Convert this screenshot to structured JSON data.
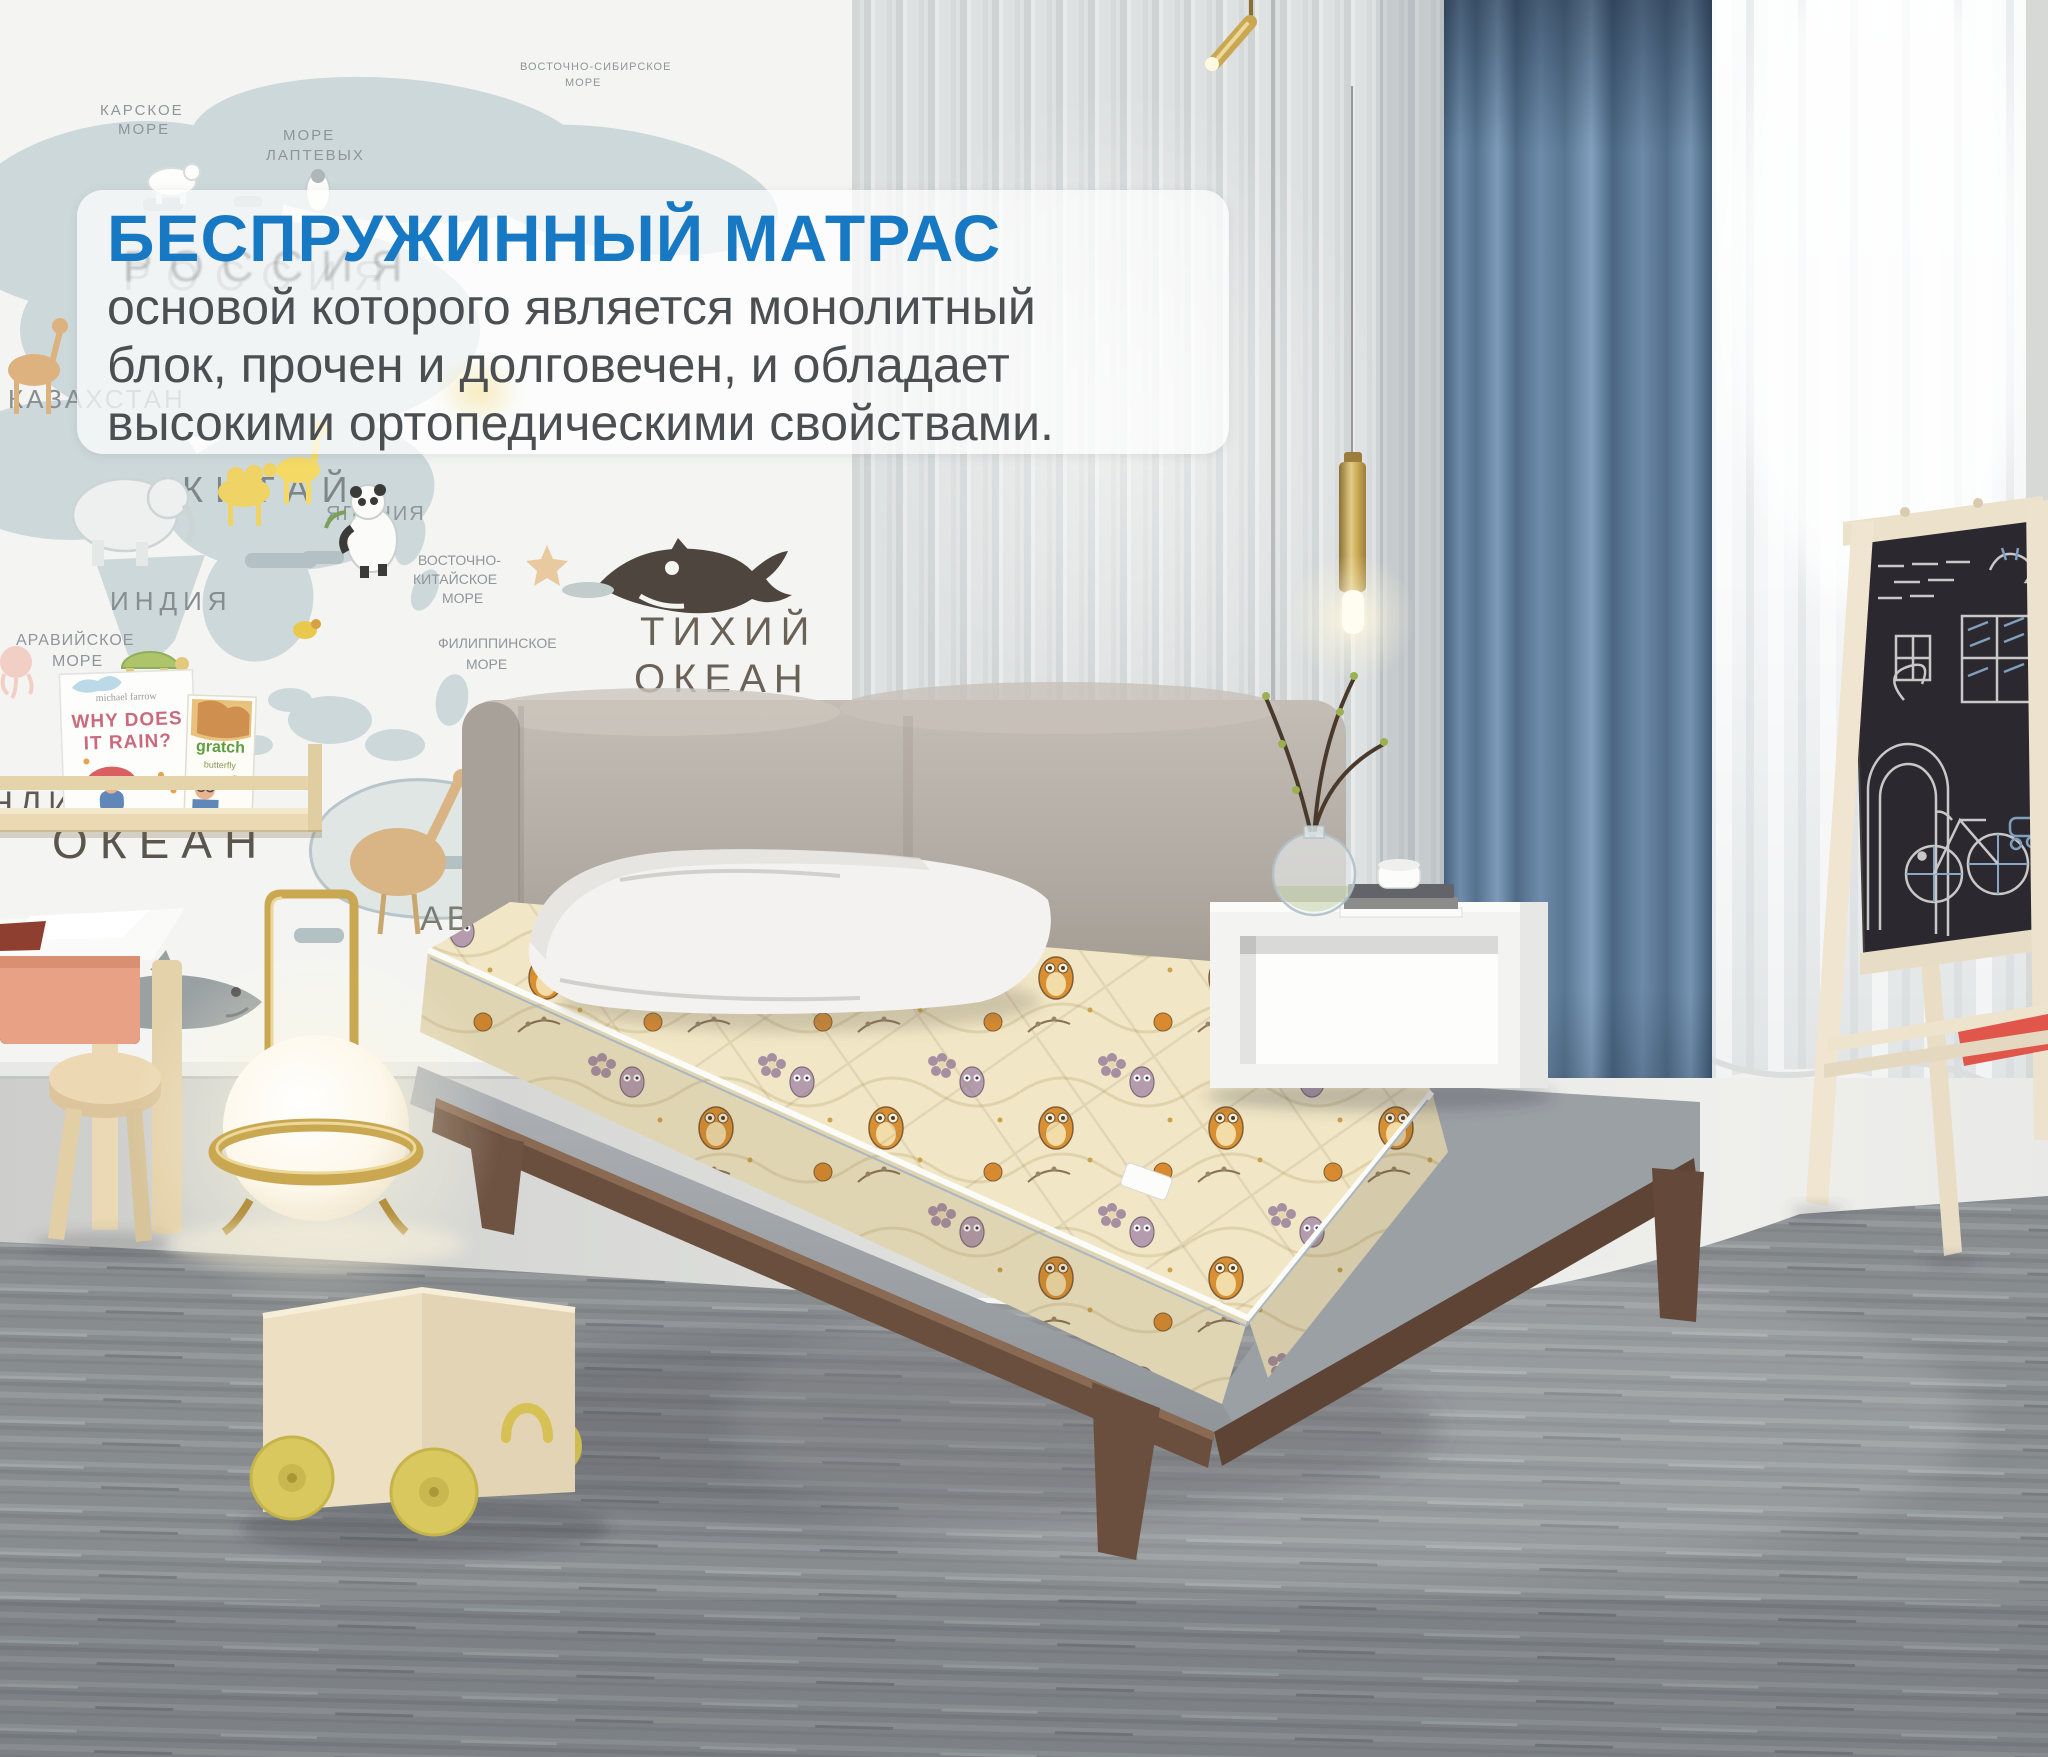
{
  "overlay": {
    "heading": "БЕСПРУЖИННЫЙ МАТРАС",
    "body_lines": [
      "основой которого является монолитный",
      "блок, прочен и долговечен, и обладает",
      "высокими ортопедическими свойствами."
    ]
  },
  "map": {
    "labels": [
      "КАРСКОЕ",
      "МОРЕ",
      "МОРЕ",
      "ЛАПТЕВЫХ",
      "ВОСТОЧНО-СИБИРСКОЕ",
      "МОРЕ",
      "РОССИЯ",
      "КАЗАХСТАН",
      "КИТАЙ",
      "ЯПОНИЯ",
      "ИНДИЯ",
      "АРАВИЙСКОЕ",
      "МОРЕ",
      "ВОСТОЧНО-",
      "КИТАЙСКОЕ",
      "МОРЕ",
      "ФИЛИППИНСКОЕ",
      "МОРЕ",
      "ТИХИЙ",
      "ОКЕАН",
      "ИНДИЙСКИЙ",
      "ОКЕАН",
      "ABC"
    ]
  },
  "bookshelf": {
    "book1_author": "michael farrow",
    "book1_title_line1": "WHY DOES",
    "book1_title_line2": "IT RAIN?",
    "book2_word": "gratch",
    "book2_subword": "butterfly"
  },
  "colors": {
    "accent_blue": "#1778c3",
    "body_text": "#4c4f52",
    "curtain_blue": "#5d7da0",
    "mattress_cream": "#f1e7c6",
    "owl_orange": "#da9030",
    "wood_walnut": "#6b4f3e",
    "wood_birch": "#ead9b4",
    "wheel_yellow": "#d9c85e"
  }
}
